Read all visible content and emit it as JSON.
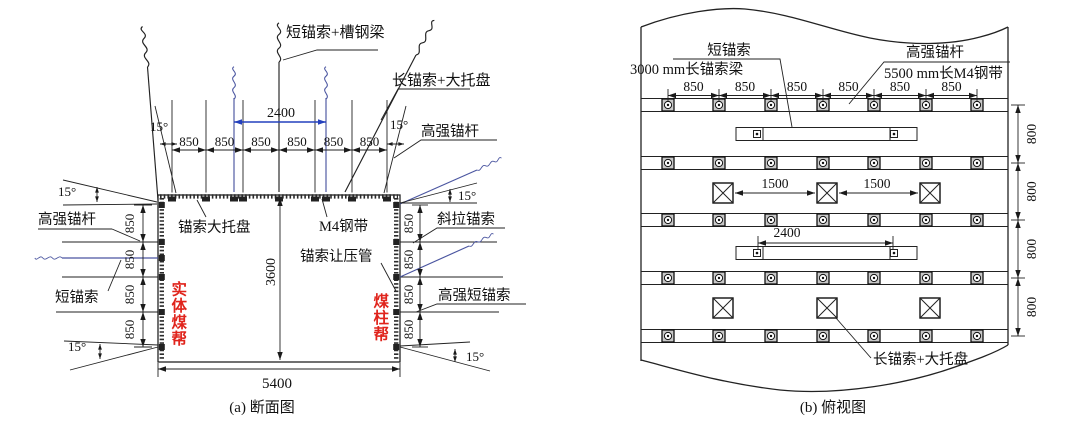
{
  "colors": {
    "accent_blue": "#2440bd",
    "cable_blue": "#4a55a0",
    "red": "#e0241c",
    "ink": "#222222"
  },
  "section_a": {
    "caption": "(a) 断面图",
    "labels": {
      "roof_cable_beam": "短锚索+槽钢梁",
      "long_cable_tray": "长锚索+大托盘",
      "bolt_right": "高强锚杆",
      "bolt_left": "高强锚杆",
      "short_cable": "短锚索",
      "diag_cable": "斜拉锚索",
      "hs_short_cable": "高强短锚索",
      "cable_tray": "锚索大托盘",
      "m4_belt": "M4钢带",
      "yield_tube": "锚索让压管",
      "solid_coal_wall": "实体煤帮",
      "pillar_wall": "煤柱帮"
    },
    "dims": {
      "span": "2400",
      "roof_spacing": [
        "850",
        "850",
        "850",
        "850",
        "850",
        "850"
      ],
      "left_spacing": [
        "850",
        "850",
        "850",
        "850"
      ],
      "right_spacing": [
        "850",
        "850",
        "850",
        "850"
      ],
      "height": "3600",
      "width": "5400",
      "angles": [
        "15°",
        "15°",
        "15°",
        "15°",
        "15°",
        "15°"
      ]
    }
  },
  "section_b": {
    "caption": "(b) 俯视图",
    "labels": {
      "short_cable": "短锚索",
      "cable_beam": "3000 mm长锚索梁",
      "bolt": "高强锚杆",
      "m4_belt": "5500 mm长M4钢带",
      "long_cable_tray": "长锚索+大托盘"
    },
    "dims": {
      "top_spacing": [
        "850",
        "850",
        "850",
        "850",
        "850",
        "850"
      ],
      "row_spacing": [
        "800",
        "800",
        "800",
        "800"
      ],
      "cable_spacing": [
        "1500",
        "1500"
      ],
      "beam_span": "2400"
    }
  }
}
